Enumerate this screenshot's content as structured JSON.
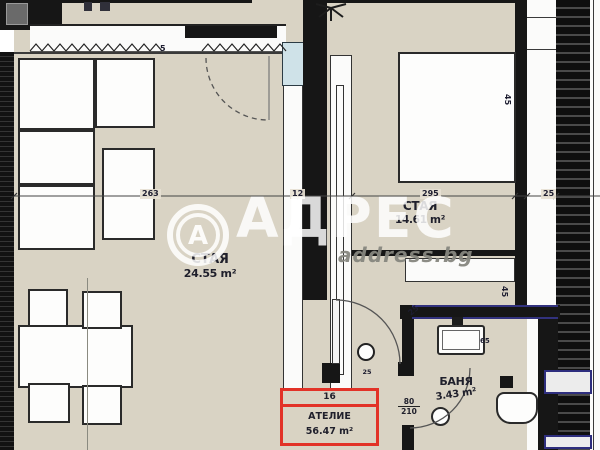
{
  "watermark": {
    "logo_letter": "А",
    "brand": "АДРЕС",
    "site": "address.bg"
  },
  "rooms": {
    "living": {
      "name": "СТАЯ",
      "area": "24.55 m²"
    },
    "bedroom": {
      "name": "СТАЯ",
      "area": "14.61 m²"
    },
    "bath": {
      "name": "БАНЯ",
      "area": "3.43 m²"
    }
  },
  "highlight": {
    "number": "16",
    "label": "АТЕЛИЕ",
    "area": "56.47 m²"
  },
  "dims": {
    "living_width": "263",
    "wall_thickness": "12",
    "bedroom_width": "295",
    "shaft_width": "25",
    "top_gap": "5",
    "bedroom_side": "45",
    "hall_side": "45",
    "bath_corner": "25",
    "tub_width": "65",
    "door_width": "80",
    "door_height": "210",
    "column_mark": "25"
  },
  "colors": {
    "floor": "#d9d3c4",
    "wall": "#161616",
    "highlight_red": "#e23227",
    "detail_blue": "#32327e",
    "glass": "#cfe2e8"
  }
}
